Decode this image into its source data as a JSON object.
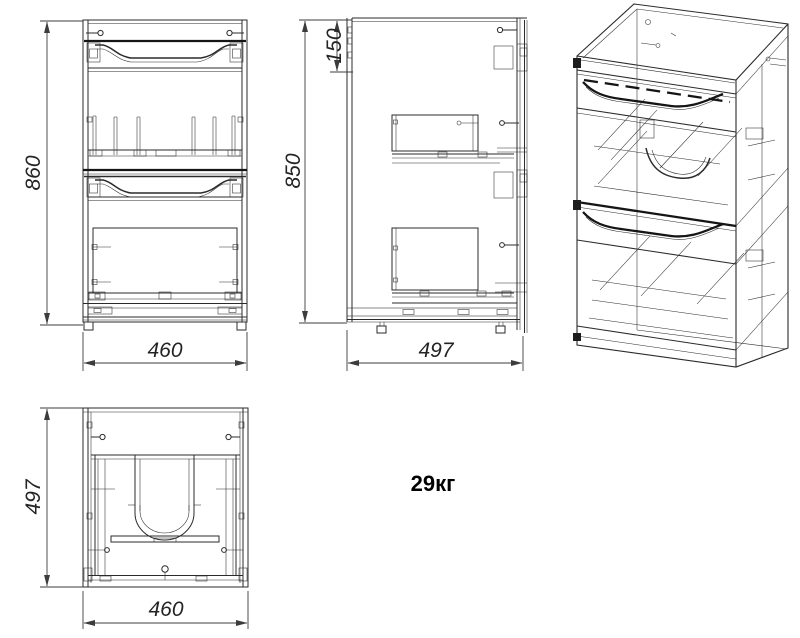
{
  "drawing": {
    "background": "#ffffff",
    "line_color": "#2b2b2b",
    "dimension_color": "#3c3c3c",
    "weight_label": "29кг",
    "dimensions": {
      "front_height": "860",
      "front_width": "460",
      "side_height": "850",
      "side_top_section": "150",
      "side_depth": "497",
      "top_depth": "497",
      "top_width": "460"
    }
  }
}
